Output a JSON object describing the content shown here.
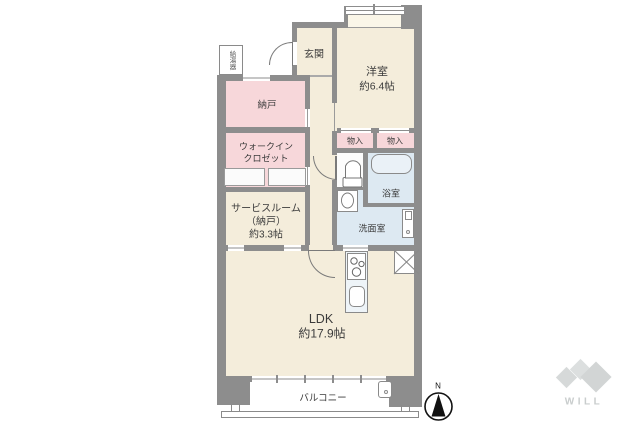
{
  "plan": {
    "rooms": {
      "genkan": "玄関",
      "yoshitsu_name": "洋室",
      "yoshitsu_size": "約6.4帖",
      "nando": "納戸",
      "wic_line1": "ウォークイン",
      "wic_line2": "クロゼット",
      "service_line1": "サービスルーム",
      "service_line2": "（納戸）",
      "service_line3": "約3.3帖",
      "storage_left": "物入",
      "storage_right": "物入",
      "bath": "浴室",
      "washroom": "洗面室",
      "ldk_name": "LDK",
      "ldk_size": "約17.9帖",
      "balcony": "バルコニー",
      "water_heater": "給湯器"
    },
    "compass": {
      "label": "N"
    },
    "logo": {
      "text": "WILL"
    },
    "colors": {
      "room_cream": "#f4eddb",
      "room_pink": "#f7d7da",
      "room_blue": "#dde9f2",
      "bay_cream": "#faf6e8",
      "wall_gray": "#8d8d8d",
      "counter_blue": "#eef4f8",
      "logo_gray": "#d4d7d7"
    }
  }
}
